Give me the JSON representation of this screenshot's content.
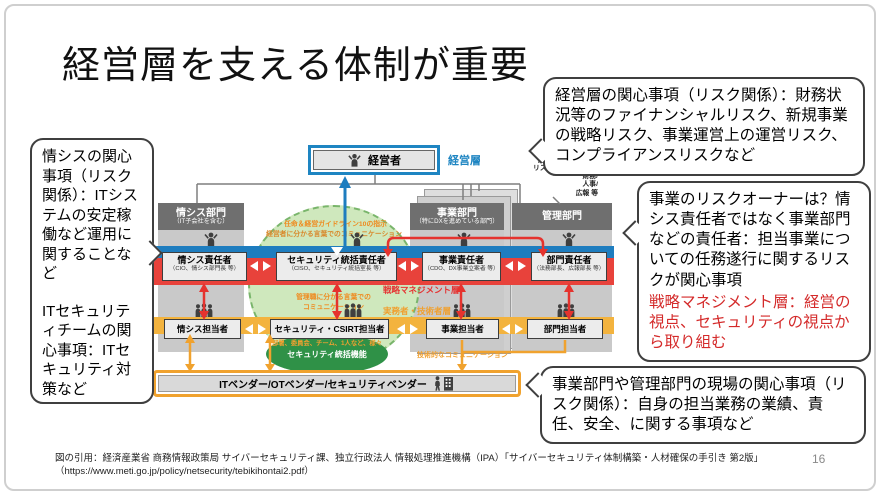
{
  "slide": {
    "title": "経営層を支える体制が重要",
    "page_number": "16"
  },
  "footer": {
    "citation_line1": "図の引用：経済産業省 商務情報政策局 サイバーセキュリティ課、独立行政法人 情報処理推進機構（IPA）「サイバーセキュリティ体制構築・人材確保の手引き 第2版」",
    "citation_line2": "（https://www.meti.go.jp/policy/netsecurity/tebikihontai2.pdf）"
  },
  "callouts": {
    "left": {
      "p1": "情シスの関心事項（リスク関係）：ITシステムの安定稼働など運用に関することなど",
      "p2": "ITセキュリティチームの関心事項：ITセキュリティ対策など"
    },
    "top_right": {
      "text": "経営層の関心事項（リスク関係）：財務状況等のファイナンシャルリスク、新規事業の戦略リスク、事業運営上の運営リスク、コンプライアンスリスクなど"
    },
    "mid_right": {
      "black": "事業のリスクオーナーは？情シス責任者ではなく事業部門などの責任者：担当事業についての任務遂行に関するリスクが関心事項",
      "red": "戦略マネジメント層：経営の視点、セキュリティの視点から取り組む"
    },
    "bottom_right": {
      "text": "事業部門や管理部門の現場の関心事項（リスク関係）：自身の担当業務の業績、責任、安全、に関する事項など"
    }
  },
  "diagram": {
    "executive": {
      "label": "経営者",
      "layer_label": "経営層"
    },
    "departments": {
      "it": {
        "name": "情シス部門",
        "sub": "（IT子会社を含む）"
      },
      "business": {
        "name": "事業部門",
        "sub": "（特にDXを進めている部門）"
      },
      "admin": {
        "name": "管理部門",
        "note": "総務/経営企画/法務/\nリスク管理/内部監査/\n財務/\n人事/\n広報 等"
      }
    },
    "managers": [
      {
        "title": "情シス責任者",
        "sub": "（CIO、情シス部門長 等）"
      },
      {
        "title": "セキュリティ統括責任者",
        "sub": "（CISO、セキュリティ統括室長 等）"
      },
      {
        "title": "事業責任者",
        "sub": "（CDO、DX事業立案者 等）"
      },
      {
        "title": "部門責任者",
        "sub": "（法務部長、広報部長 等）"
      }
    ],
    "staff": [
      {
        "title": "情シス担当者"
      },
      {
        "title": "セキュリティ・CSIRT担当者"
      },
      {
        "title": "事業担当者"
      },
      {
        "title": "部門担当者"
      }
    ],
    "layers": {
      "strategic": "戦略マネジメント層",
      "operational": "実務者・技術者層"
    },
    "notes": {
      "appointment": "任命＆経営ガイドライン10の指示",
      "exec_comm": "経営者に分かる言葉でのコミュニケーション",
      "manager_comm": "管理職に分かる言葉での\nコミュニケーション",
      "teams": "部署、委員会、チーム、1人など、様々",
      "sec_function": "セキュリティ統括機能",
      "tech_comm": "技術的なコミュニケーション"
    },
    "vendor": {
      "label": "ITベンダー/OTベンダー/セキュリティベンダー"
    }
  },
  "colors": {
    "accent_blue": "#1e7dbf",
    "accent_red": "#e8423b",
    "accent_orange": "#f0a22e",
    "green_light": "#cfe8bd",
    "green_dark": "#2f9147",
    "dept_gray": "#6f6f6f"
  }
}
